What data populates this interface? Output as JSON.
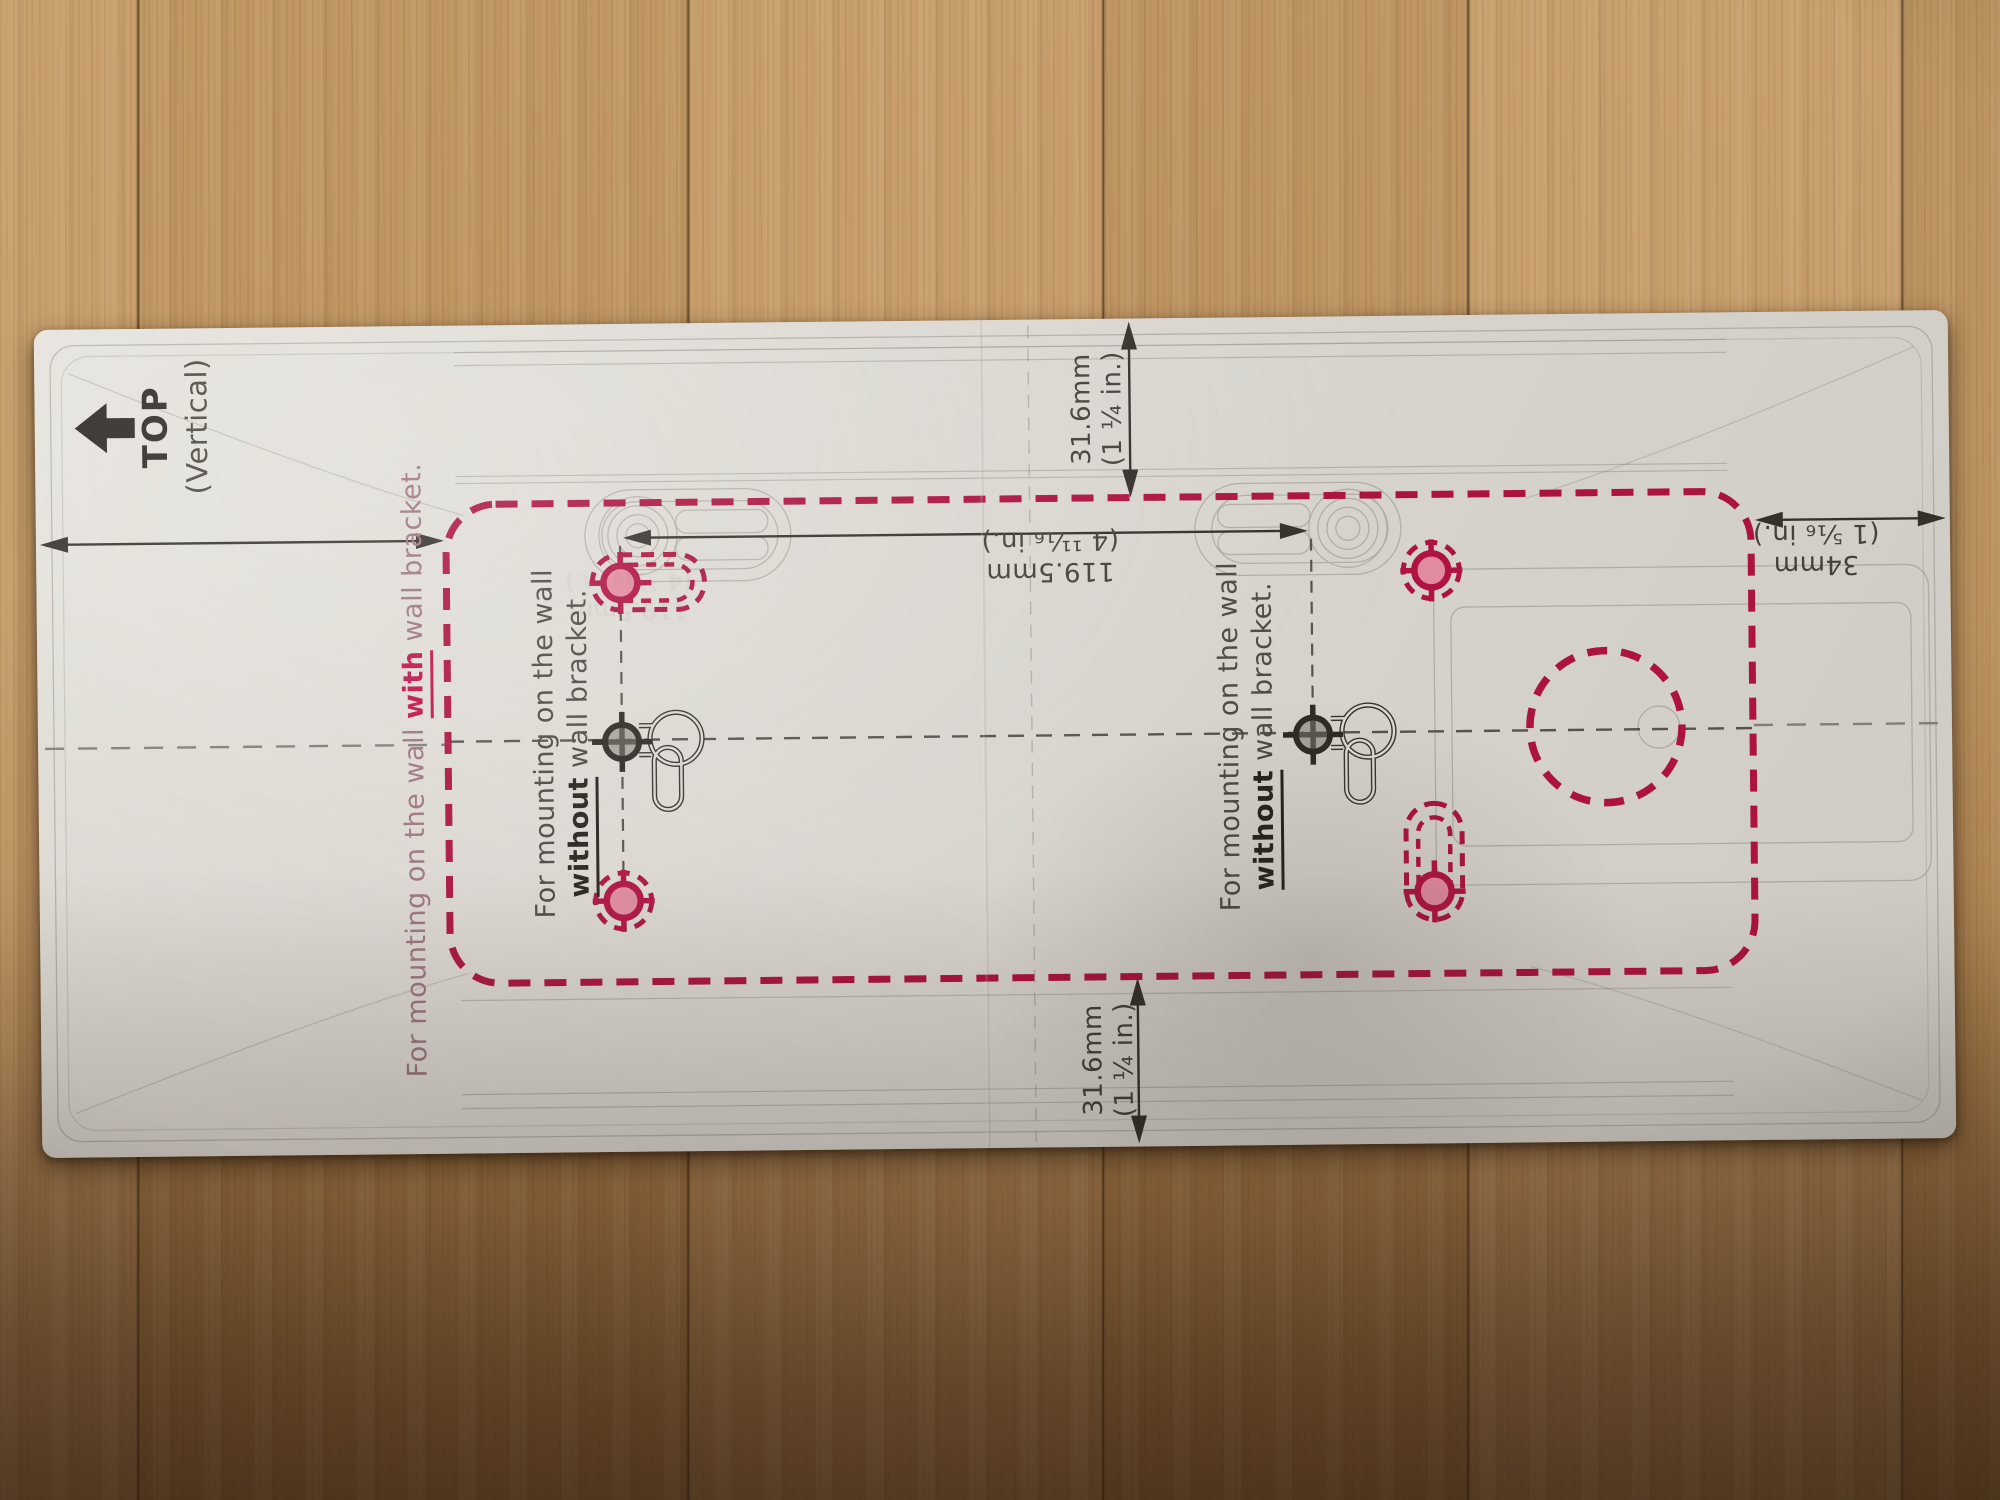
{
  "template": {
    "top_marker": {
      "label": "TOP",
      "sublabel": "(Vertical)"
    },
    "notes": {
      "with_bracket": {
        "prefix": "For mounting on the wall ",
        "emphasis": "with",
        "suffix": " wall bracket."
      },
      "without_bracket_left": {
        "line1": "For mounting on the wall",
        "emphasis": "without",
        "suffix": " wall bracket."
      },
      "without_bracket_right": {
        "line1": "For mounting on the wall",
        "emphasis": "without",
        "suffix": " wall bracket."
      }
    },
    "dimensions": {
      "top_offset": {
        "mm": "31.6mm",
        "inch": "(1 ¼ in.)"
      },
      "bottom_offset": {
        "mm": "31.6mm",
        "inch": "(1 ¼ in.)"
      },
      "hole_spacing": {
        "mm": "119.5mm",
        "inch": "(4 ¹¹⁄₁₆ in.)"
      },
      "side_offset": {
        "mm": "34mm",
        "inch": "(1 ⁵⁄₁₆ in.)"
      }
    },
    "colors": {
      "accent_red": "#ac1340",
      "ink": "#46413b",
      "paper": "#dfdcd6"
    }
  }
}
